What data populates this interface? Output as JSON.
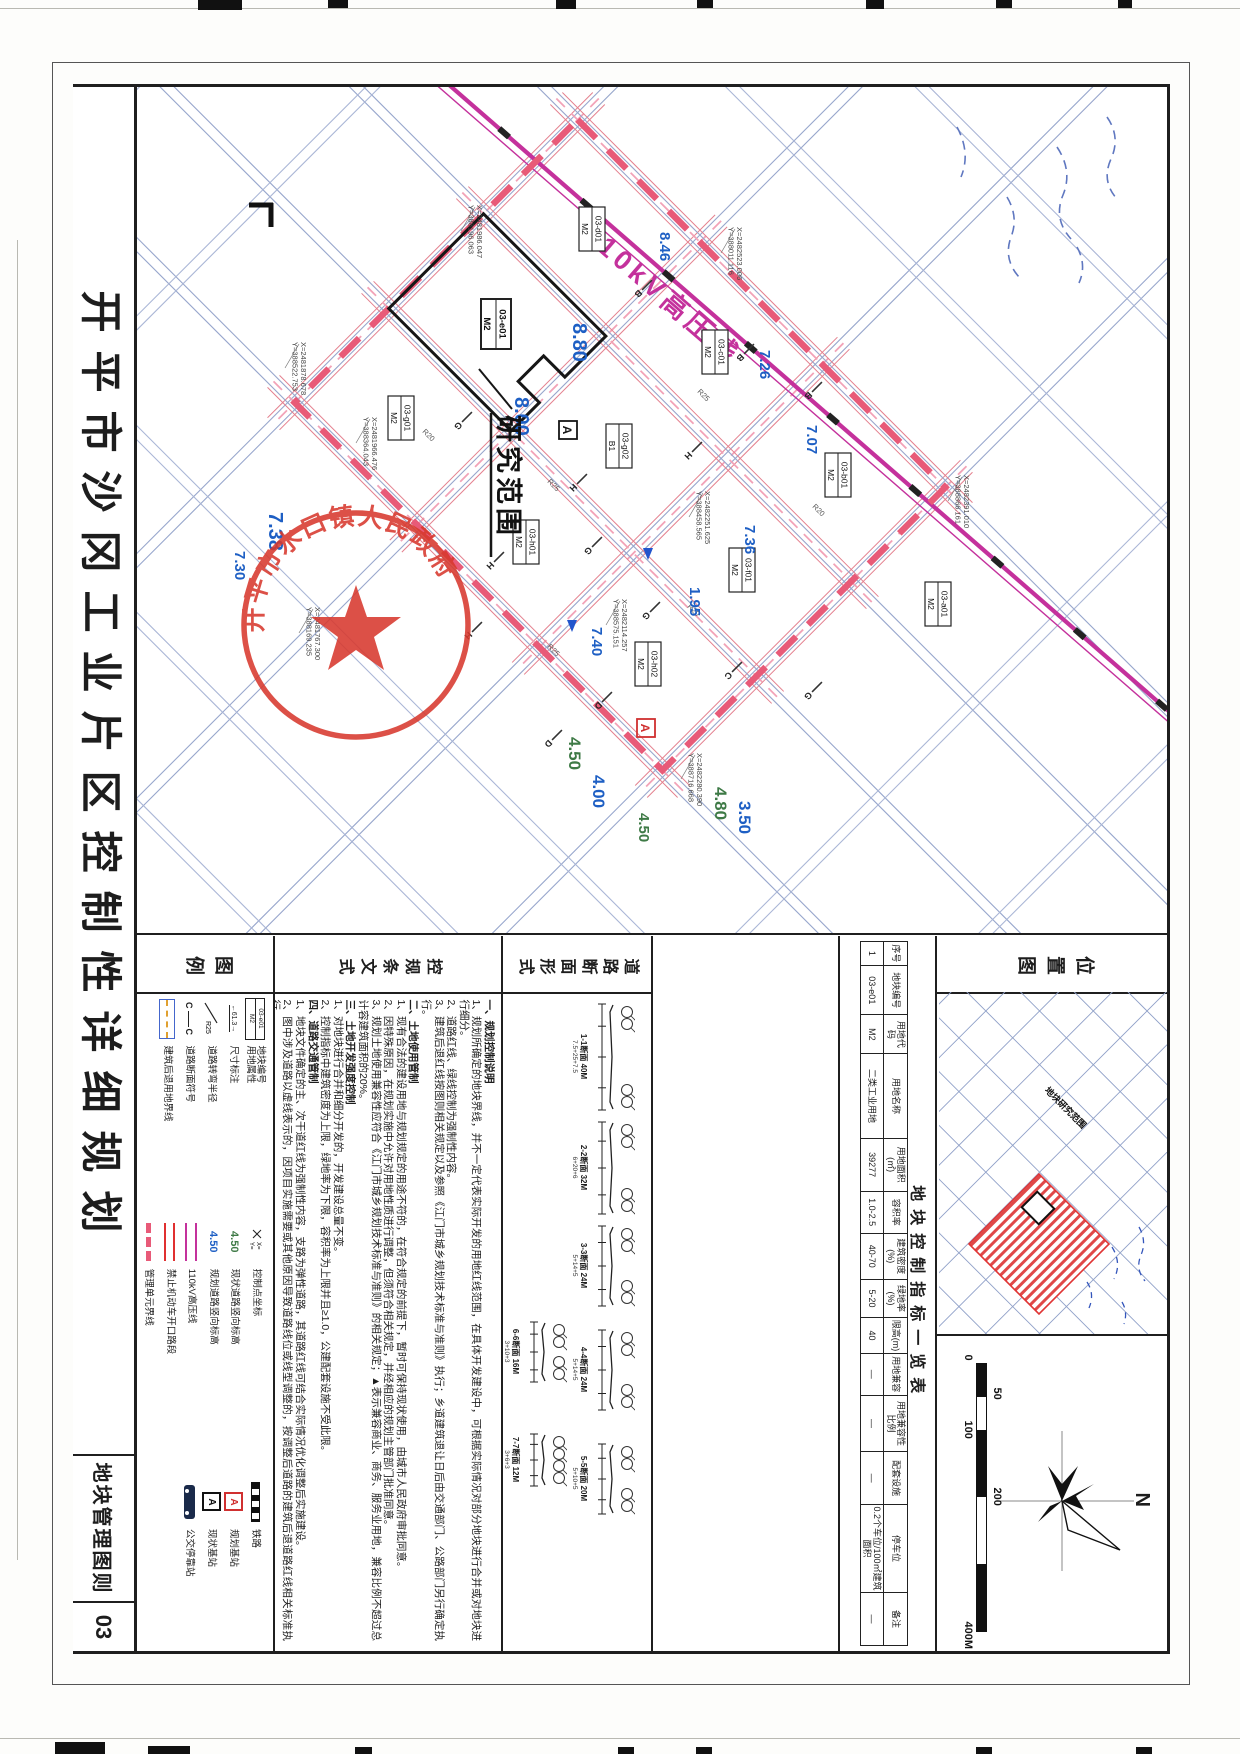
{
  "sheet": {
    "title": "开平市沙冈工业片区控制性详细规划",
    "sheet_label": "地块管理图则",
    "sheet_no": "03"
  },
  "map": {
    "hv_label": "110kV高压线",
    "research_label": "研究范围",
    "seal_text": "开平市水口镇人民政府",
    "plots": [
      {
        "id": "03-d01",
        "use": "M2",
        "x": 142,
        "y": 575,
        "main": false
      },
      {
        "id": "03-c01",
        "use": "M2",
        "x": 265,
        "y": 452,
        "main": false
      },
      {
        "id": "03-b01",
        "use": "M2",
        "x": 388,
        "y": 329,
        "main": false
      },
      {
        "id": "03-e01",
        "use": "M2",
        "x": 237,
        "y": 671,
        "main": true
      },
      {
        "id": "03-g02",
        "use": "B1",
        "x": 359,
        "y": 548,
        "main": false
      },
      {
        "id": "03-f01",
        "use": "M2",
        "x": 483,
        "y": 425,
        "main": false
      },
      {
        "id": "03-g01",
        "use": "M2",
        "x": 331,
        "y": 766,
        "main": false
      },
      {
        "id": "03-h01",
        "use": "M2",
        "x": 455,
        "y": 641,
        "main": false
      },
      {
        "id": "03-h02",
        "use": "M2",
        "x": 577,
        "y": 519,
        "main": false
      },
      {
        "id": "03-a01",
        "use": "M2",
        "x": 517,
        "y": 229,
        "main": false
      }
    ],
    "elevations": [
      {
        "v": "8.46",
        "x": 145,
        "y": 507,
        "c": "blue",
        "s": 15
      },
      {
        "v": "8.80",
        "x": 236,
        "y": 594,
        "c": "blue",
        "s": 20
      },
      {
        "v": "8.00",
        "x": 310,
        "y": 652,
        "c": "blue",
        "s": 20
      },
      {
        "v": "7.26",
        "x": 263,
        "y": 407,
        "c": "blue",
        "s": 15
      },
      {
        "v": "7.07",
        "x": 338,
        "y": 360,
        "c": "blue",
        "s": 15
      },
      {
        "v": "7.36",
        "x": 438,
        "y": 422,
        "c": "blue",
        "s": 15
      },
      {
        "v": "7.40",
        "x": 540,
        "y": 575,
        "c": "blue",
        "s": 15
      },
      {
        "v": "1.95",
        "x": 500,
        "y": 477,
        "c": "blue",
        "s": 15
      },
      {
        "v": "4.80",
        "x": 700,
        "y": 452,
        "c": "green",
        "s": 17
      },
      {
        "v": "3.50",
        "x": 714,
        "y": 428,
        "c": "blue",
        "s": 17
      },
      {
        "v": "4.50",
        "x": 726,
        "y": 528,
        "c": "green",
        "s": 15
      },
      {
        "v": "4.50",
        "x": 650,
        "y": 598,
        "c": "green",
        "s": 17
      },
      {
        "v": "4.00",
        "x": 688,
        "y": 574,
        "c": "blue",
        "s": 17
      },
      {
        "v": "7.38",
        "x": 425,
        "y": 898,
        "c": "blue",
        "s": 20
      },
      {
        "v": "7.30",
        "x": 464,
        "y": 932,
        "c": "blue",
        "s": 15
      }
    ],
    "coords": [
      {
        "x": "X=2482523.006",
        "y": "Y=388011.116",
        "px": 140,
        "py": 430
      },
      {
        "x": "X=2481986.047",
        "y": "Y=388196.063",
        "px": 118,
        "py": 690
      },
      {
        "x": "X=2481966.476",
        "y": "Y=388364.043",
        "px": 330,
        "py": 795
      },
      {
        "x": "X=2481878.678",
        "y": "Y=388522.753",
        "px": 255,
        "py": 866
      },
      {
        "x": "X=2481767.300",
        "y": "Y=388169.235",
        "px": 520,
        "py": 852
      },
      {
        "x": "X=2482114.257",
        "y": "Y=388575.151",
        "px": 512,
        "py": 545
      },
      {
        "x": "X=2482251.625",
        "y": "Y=388458.565",
        "px": 404,
        "py": 462
      },
      {
        "x": "X=2482280.390",
        "y": "Y=388716.668",
        "px": 666,
        "py": 470
      },
      {
        "x": "X=2482391.010",
        "y": "Y=388866.161",
        "px": 388,
        "py": 203
      }
    ],
    "radii": [
      {
        "t": "R25",
        "x": 305,
        "y": 470
      },
      {
        "t": "R20",
        "x": 420,
        "y": 355
      },
      {
        "t": "R25",
        "x": 395,
        "y": 620
      },
      {
        "t": "R20",
        "x": 520,
        "y": 480
      },
      {
        "t": "R20",
        "x": 345,
        "y": 745
      },
      {
        "t": "R25",
        "x": 560,
        "y": 620
      }
    ],
    "ticks": [
      {
        "t": "B",
        "x": 198,
        "y": 520
      },
      {
        "t": "B",
        "x": 262,
        "y": 418
      },
      {
        "t": "G",
        "x": 455,
        "y": 570
      },
      {
        "t": "G",
        "x": 520,
        "y": 512
      },
      {
        "t": "H",
        "x": 392,
        "y": 585
      },
      {
        "t": "H",
        "x": 470,
        "y": 668
      },
      {
        "t": "H",
        "x": 540,
        "y": 690
      },
      {
        "t": "D",
        "x": 610,
        "y": 560
      },
      {
        "t": "D",
        "x": 648,
        "y": 610
      },
      {
        "t": "G",
        "x": 330,
        "y": 700
      },
      {
        "t": "B",
        "x": 300,
        "y": 350
      },
      {
        "t": "C",
        "x": 580,
        "y": 430
      },
      {
        "t": "H",
        "x": 360,
        "y": 470
      },
      {
        "t": "G",
        "x": 600,
        "y": 350
      }
    ]
  },
  "location": {
    "title": "位置图",
    "area_label": "地块研究范围",
    "north_label": "N",
    "scale_labels": [
      "0",
      "50",
      "100",
      "200",
      "400M"
    ]
  },
  "indicators": {
    "title": "地块控制指标一览表",
    "columns": [
      {
        "label": "序号",
        "value": "1",
        "w": 3.5
      },
      {
        "label": "地块编号",
        "value": "03-e01",
        "w": 7
      },
      {
        "label": "用地代码",
        "value": "M2",
        "w": 5.5
      },
      {
        "label": "用地名称",
        "value": "二类工业用地",
        "w": 12
      },
      {
        "label": "用地面积(㎡)",
        "value": "39277",
        "w": 7.5
      },
      {
        "label": "容积率",
        "value": "1.0-2.5",
        "w": 6
      },
      {
        "label": "建筑密度(%)",
        "value": "40-70",
        "w": 6.5
      },
      {
        "label": "绿地率(%)",
        "value": "5-20",
        "w": 5.5
      },
      {
        "label": "限高(m)",
        "value": "40",
        "w": 5
      },
      {
        "label": "用地兼容",
        "value": "—",
        "w": 6
      },
      {
        "label": "用地兼容性比例",
        "value": "—",
        "w": 8
      },
      {
        "label": "配套设施",
        "value": "—",
        "w": 7.5
      },
      {
        "label": "停车位",
        "value": "0.2个车位/100㎡建筑面积",
        "w": 12.5
      },
      {
        "label": "备注",
        "value": "—",
        "w": 7.5
      }
    ]
  },
  "road_sections": {
    "title": "道路断面形式",
    "items": [
      {
        "caption": "1-1断面 40M",
        "dims": "7.5+25+7.5",
        "wpx": 110,
        "row": 0,
        "x": 66
      },
      {
        "caption": "2-2断面 32M",
        "dims": "6+20+6",
        "wpx": 96,
        "row": 0,
        "x": 184
      },
      {
        "caption": "3-3断面 24M",
        "dims": "5+14+5",
        "wpx": 84,
        "row": 0,
        "x": 288
      },
      {
        "caption": "4-4断面 24M",
        "dims": "5+14+5",
        "wpx": 84,
        "row": 0,
        "x": 392
      },
      {
        "caption": "5-5断面 20M",
        "dims": "5+10+5",
        "wpx": 74,
        "row": 0,
        "x": 506
      },
      {
        "caption": "6-6断面 16M",
        "dims": "3+10+3",
        "wpx": 64,
        "row": 1,
        "x": 384
      },
      {
        "caption": "7-7断面 12M",
        "dims": "3+6+3",
        "wpx": 56,
        "row": 1,
        "x": 496
      }
    ]
  },
  "provisions": {
    "title": "控规条文式",
    "sections": [
      {
        "heading": "一、规划控制说明",
        "items": [
          "1、规划所确定的地块界线，并不一定代表实际开发的用地红线范围，在具体开发建设中，可根据实际情况对部分地块进行合并或对地块进行细分。",
          "2、道路红线、绿线控制为强制性内容。",
          "3、建筑后退红线按图则相关规定以及参照《江门市城乡规划技术标准与准则》执行；乡道建筑退让日后由交通部门、公路部门另行确定执行。"
        ]
      },
      {
        "heading": "二、土地使用管制",
        "items": [
          "1、现有合法的建设用地与规划规定的用途不符的，在符合规定的前提下，暂时可保持现状使用，由城市人民政府审批同意。",
          "2、因特殊原因，在规划实施中允许对用地性质进行调整，但须符合相关规定，并经相应的规划主管部门批准同意。",
          "3、规划土地使用兼容性应符合《江门市城乡规划技术标准与准则》的相关规定；▲表示兼容商业、商务、服务业用地，兼容比例不超过总计容建筑面积的20%。"
        ]
      },
      {
        "heading": "三、土地开发强度控制",
        "items": [
          "1、对地块进行合并和细分开发的，开发建设总量不变。",
          "2、控制指标中建筑密度为上限，绿地率为下限，容积率为上限并且≥1.0，公建配套设施不受此限。"
        ]
      },
      {
        "heading": "四、道路交通管制",
        "items": [
          "1、地块文件确定的主、次干道红线为强制性内容，支路为弹性道路，其道路红线可结合实际情况优化调整后实施建设。",
          "2、图中涉及道路以虚线表示的，因项目实施需要或其他原因导致道路线位或线型调整的，按调整后道路的建筑后退道路红线相关标准执行。",
          "3、竖向标高结合地块整体开发时实施；为减少拆迁，尽量利用现状地形及其周边场地竖向衔接。"
        ]
      }
    ]
  },
  "legend": {
    "title": "图例",
    "symbol_text": {
      "plot_id": "03-e01",
      "plot_use": "M2",
      "dim": "61.3",
      "radius": "R25",
      "section": "C—C",
      "elev": "4.50",
      "station": "A"
    },
    "groups": [
      [
        {
          "sym": "plot-box",
          "label": "地块编号",
          "label2": "用地属性"
        },
        {
          "sym": "dim",
          "label": "尺寸标注",
          "label2": ""
        },
        {
          "sym": "radius",
          "label": "道路转弯半径",
          "label2": ""
        },
        {
          "sym": "section",
          "label": "道路断面符号",
          "label2": ""
        },
        {
          "sym": "setback",
          "label": "建筑后退用地界线",
          "label2": ""
        }
      ],
      [
        {
          "sym": "coord",
          "label": "控制点坐标",
          "label2": ""
        },
        {
          "sym": "elev-green",
          "label": "现状道路竖向标高",
          "label2": ""
        },
        {
          "sym": "elev-blue",
          "label": "规划道路竖向标高",
          "label2": ""
        },
        {
          "sym": "hv",
          "label": "110kV高压线",
          "label2": ""
        },
        {
          "sym": "noopen",
          "label": "禁止机动车开口路段",
          "label2": ""
        },
        {
          "sym": "unit",
          "label": "管理单元界线",
          "label2": ""
        }
      ],
      [
        {
          "sym": "rail",
          "label": "铁路",
          "label2": ""
        },
        {
          "sym": "bts-plan",
          "label": "规划基站",
          "label2": ""
        },
        {
          "sym": "bts-exist",
          "label": "现状基站",
          "label2": ""
        },
        {
          "sym": "bus",
          "label": "公交停靠站",
          "label2": ""
        }
      ]
    ]
  },
  "colors": {
    "road_blue": "#97a6cc",
    "road_blue_light": "#aab6d6",
    "boundary_red": "#e85a78",
    "road_red_edge": "#e4808e",
    "pink_dash": "#f2a3b8",
    "hv_magenta": "#c4319c",
    "elev_blue": "#1e5fc4",
    "elev_green": "#3e7a46",
    "seal_red": "#d8392e",
    "hatch_red": "#e04848"
  }
}
